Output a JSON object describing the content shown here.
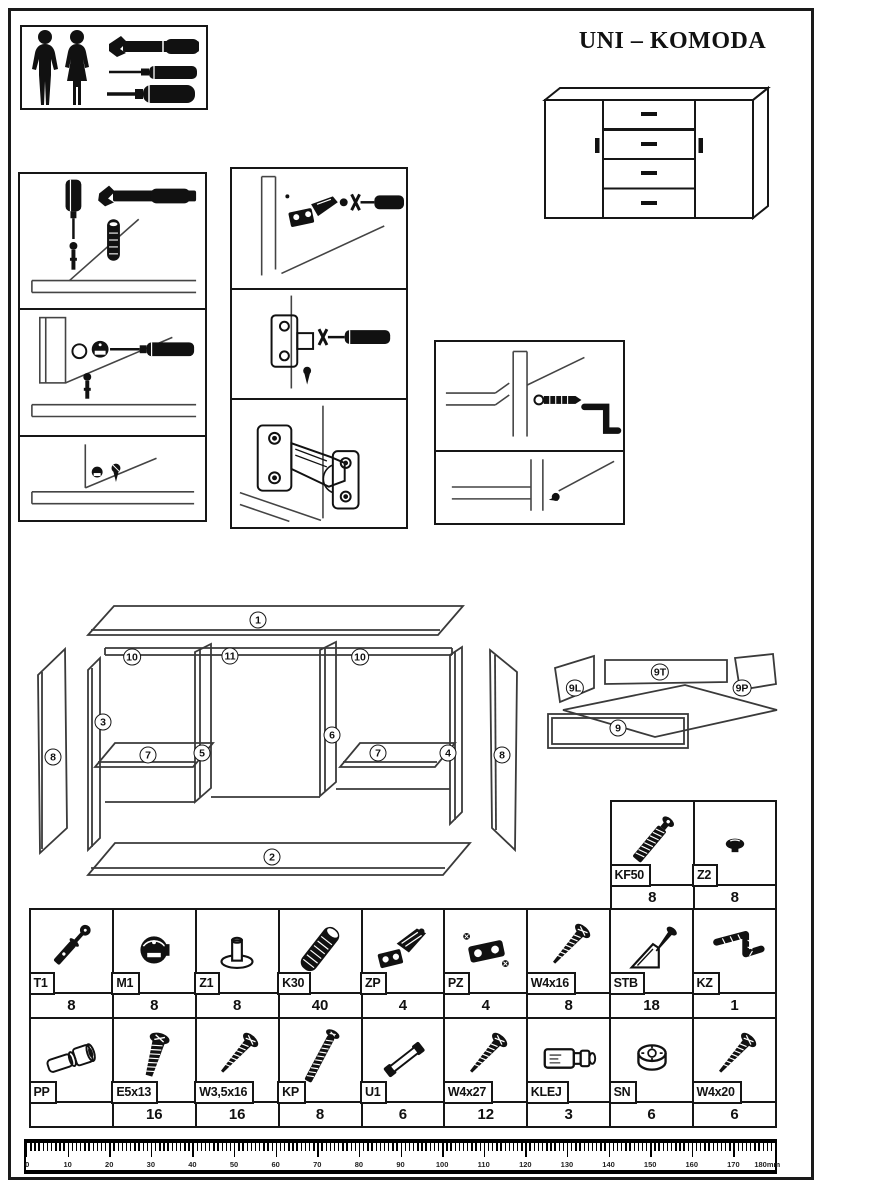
{
  "title": "UNI – KOMODA",
  "exploded_labels": [
    {
      "label": "1",
      "x": 258,
      "y": 620
    },
    {
      "label": "2",
      "x": 272,
      "y": 857
    },
    {
      "label": "3",
      "x": 103,
      "y": 722
    },
    {
      "label": "4",
      "x": 448,
      "y": 753
    },
    {
      "label": "5",
      "x": 202,
      "y": 753
    },
    {
      "label": "6",
      "x": 332,
      "y": 735
    },
    {
      "label": "7",
      "x": 148,
      "y": 755
    },
    {
      "label": "7",
      "x": 378,
      "y": 753
    },
    {
      "label": "8",
      "x": 53,
      "y": 757
    },
    {
      "label": "10",
      "x": 132,
      "y": 657
    },
    {
      "label": "11",
      "x": 230,
      "y": 656
    },
    {
      "label": "10",
      "x": 360,
      "y": 657
    },
    {
      "label": "8",
      "x": 502,
      "y": 755
    },
    {
      "label": "9L",
      "x": 575,
      "y": 688
    },
    {
      "label": "9T",
      "x": 660,
      "y": 672
    },
    {
      "label": "9P",
      "x": 742,
      "y": 688
    },
    {
      "label": "9",
      "x": 618,
      "y": 728
    }
  ],
  "hardware_small_table": [
    {
      "code": "KF50",
      "qty": "8",
      "icon": "confirmat"
    },
    {
      "code": "Z2",
      "qty": "8",
      "icon": "cap"
    }
  ],
  "hardware_table": {
    "rows": [
      [
        {
          "code": "T1",
          "qty": "8",
          "icon": "cam-bolt"
        },
        {
          "code": "M1",
          "qty": "8",
          "icon": "cam-lock"
        },
        {
          "code": "Z1",
          "qty": "8",
          "icon": "cap-pin"
        },
        {
          "code": "K30",
          "qty": "40",
          "icon": "dowel"
        },
        {
          "code": "ZP",
          "qty": "4",
          "icon": "hinge"
        },
        {
          "code": "PZ",
          "qty": "4",
          "icon": "hinge-plate"
        },
        {
          "code": "W4x16",
          "qty": "8",
          "icon": "screw"
        },
        {
          "code": "STB",
          "qty": "18",
          "icon": "bracket-screw"
        },
        {
          "code": "KZ",
          "qty": "1",
          "icon": "allen-key"
        }
      ],
      [
        {
          "code": "PP",
          "qty": "",
          "icon": "pin-bolt"
        },
        {
          "code": "E5x13",
          "qty": "16",
          "icon": "euro-screw"
        },
        {
          "code": "W3,5x16",
          "qty": "16",
          "icon": "screw"
        },
        {
          "code": "KP",
          "qty": "8",
          "icon": "confirmat-long"
        },
        {
          "code": "U1",
          "qty": "6",
          "icon": "handle"
        },
        {
          "code": "W4x27",
          "qty": "12",
          "icon": "screw"
        },
        {
          "code": "KLEJ",
          "qty": "3",
          "icon": "glue"
        },
        {
          "code": "SN",
          "qty": "6",
          "icon": "nut"
        },
        {
          "code": "W4x20",
          "qty": "6",
          "icon": "screw"
        }
      ]
    ]
  },
  "ruler": {
    "unit": "mm",
    "major_labels": [
      "0",
      "10",
      "20",
      "30",
      "40",
      "50",
      "60",
      "70",
      "80",
      "90",
      "100",
      "110",
      "120",
      "130",
      "140",
      "150",
      "160",
      "170",
      "180mm"
    ],
    "minor_ticks_per_major": 10
  }
}
